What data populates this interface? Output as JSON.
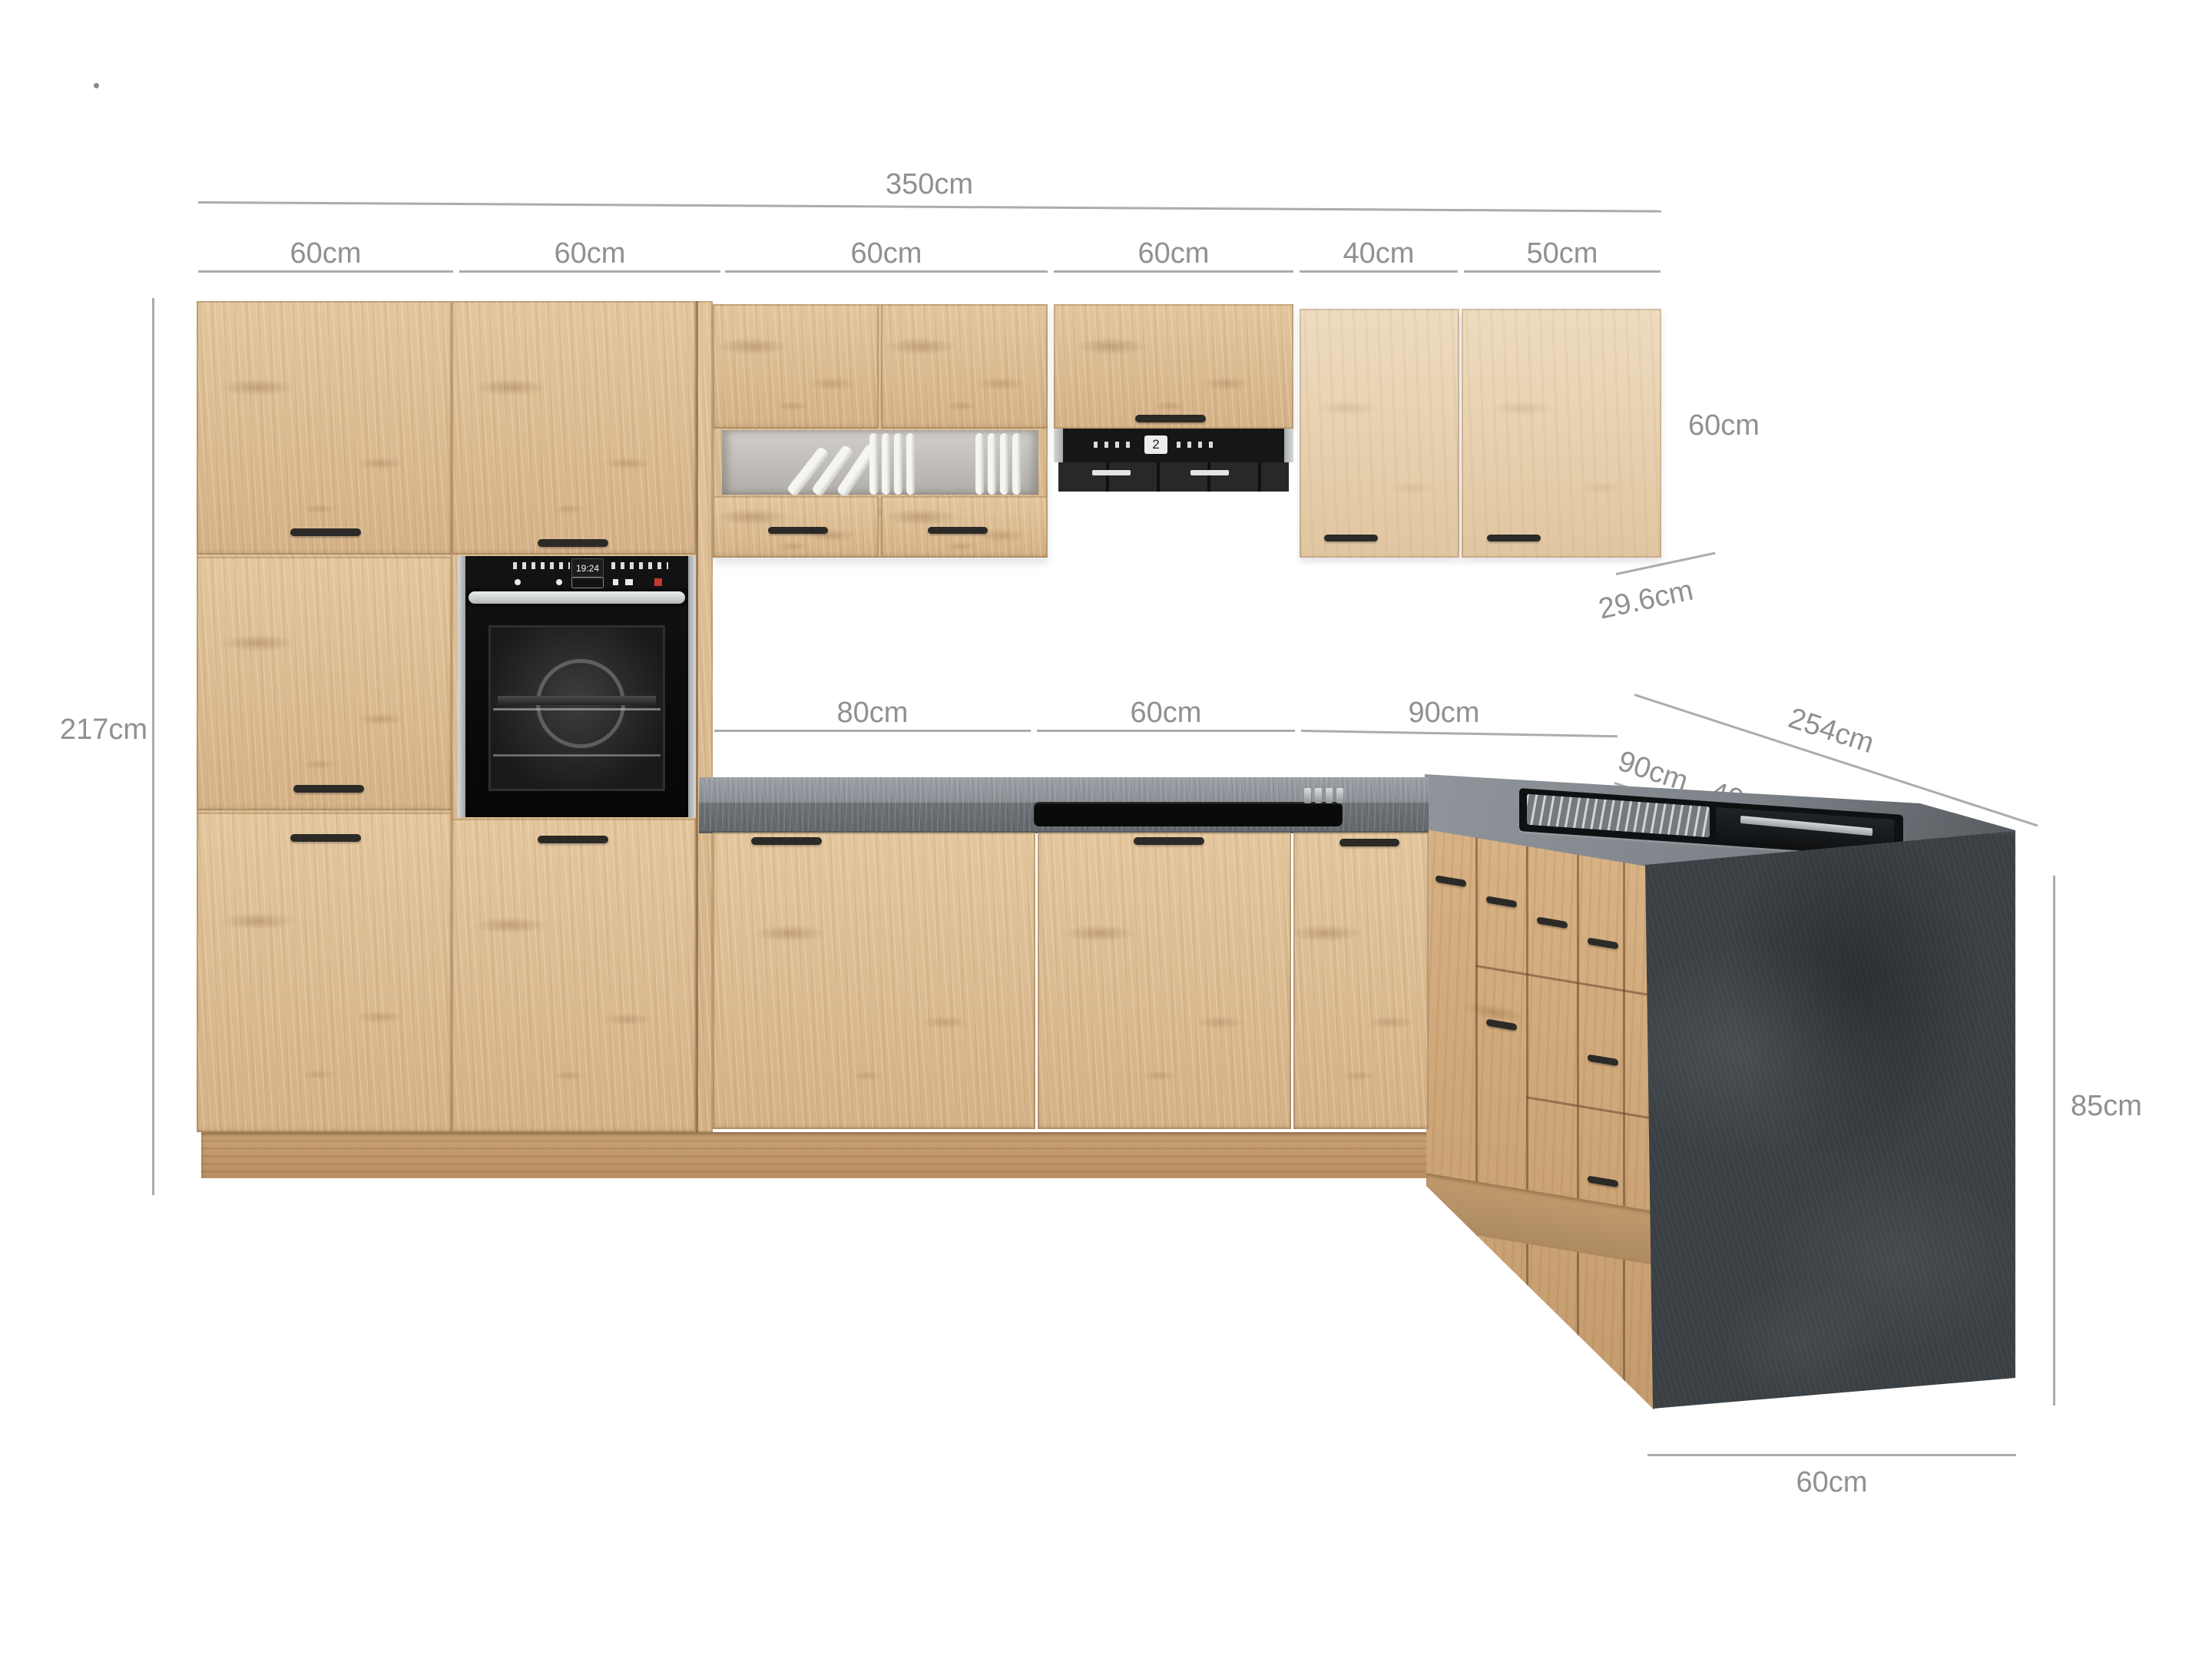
{
  "product": {
    "name": "L-shaped kitchen with dimension annotations",
    "style": "light artisan oak fronts, dark stone worktop and island panel"
  },
  "dimensions": {
    "top_total": {
      "label": "350cm"
    },
    "top_segments": [
      {
        "label": "60cm"
      },
      {
        "label": "60cm"
      },
      {
        "label": "60cm"
      },
      {
        "label": "60cm"
      },
      {
        "label": "40cm"
      },
      {
        "label": "50cm"
      }
    ],
    "left_height": {
      "label": "217cm"
    },
    "wall_cabinet_height": {
      "label": "60cm"
    },
    "wall_cabinet_depth": {
      "label": "29.6cm"
    },
    "worktop_segments": [
      {
        "label": "80cm"
      },
      {
        "label": "60cm"
      },
      {
        "label": "90cm"
      }
    ],
    "island_total": {
      "label": "254cm"
    },
    "island_segments": [
      {
        "label": "90cm"
      },
      {
        "label": "40cm"
      },
      {
        "label": "80cm"
      },
      {
        "label": "40cm"
      }
    ],
    "island_height": {
      "label": "85cm"
    },
    "island_depth": {
      "label": "60cm"
    }
  },
  "appliances": {
    "oven_display": "19:24",
    "hood_display": "2"
  },
  "colors": {
    "wood_front": "#ddbe94",
    "wood_light_front": "#ead7b8",
    "wood_plinth": "#c49e72",
    "worktop_stone": "#8a9095",
    "island_panel": "#3a3f43",
    "appliance_black": "#121212",
    "steel": "#c9cdcf",
    "handle": "#2b2a27",
    "dim_line": "#aaadad",
    "dim_text": "#8f9090"
  }
}
